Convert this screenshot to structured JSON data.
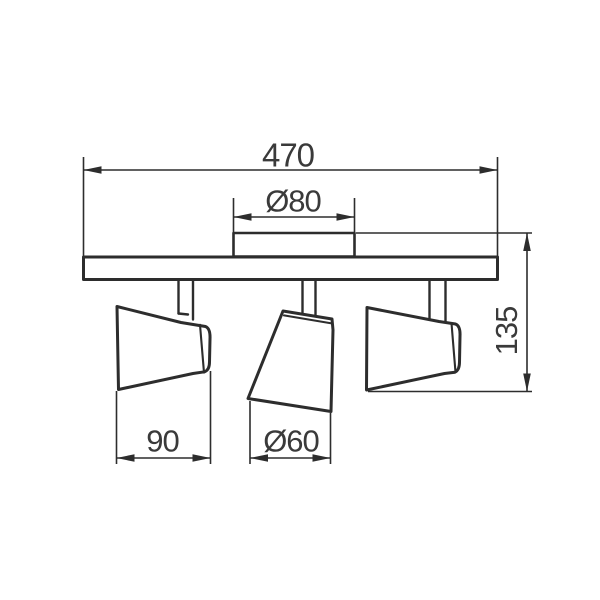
{
  "drawing": {
    "title": "ceiling-spotlight-fixture-dimension-drawing",
    "dimensions": {
      "overall_width": {
        "label": "470"
      },
      "plate_diameter": {
        "label": "Ø80"
      },
      "height": {
        "label": "135"
      },
      "head_width": {
        "label": "90"
      },
      "head_diameter": {
        "label": "Ø60"
      }
    },
    "colors": {
      "line": "#2d2d2d",
      "text": "#3a3a3a",
      "background": "#ffffff"
    }
  }
}
